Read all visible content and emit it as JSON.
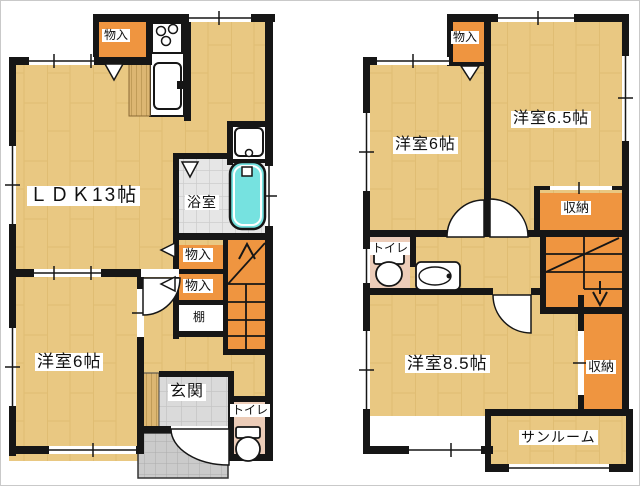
{
  "figure": {
    "type": "floor-plan",
    "floors": [
      "1F",
      "2F"
    ]
  },
  "colors": {
    "floor_wood": "#e9c882",
    "closet_orange": "#ef9540",
    "wall_black": "#161616",
    "bathtub_cyan": "#76e2e0",
    "toilet_floor_pink": "#ecccb8",
    "tile_gray": "#e6e6e6",
    "entry_gray": "#dadada",
    "porch_gray": "#cbcbcb"
  },
  "floor1": {
    "labels": {
      "closet_top": "物入",
      "ldk": "ＬＤＫ13帖",
      "bath": "浴室",
      "closet_a": "物入",
      "closet_b": "物入",
      "shelf": "棚",
      "bedroom6": "洋室6帖",
      "entrance": "玄関",
      "toilet": "トイレ"
    }
  },
  "floor2": {
    "labels": {
      "closet_top": "物入",
      "bedroom6": "洋室6帖",
      "bedroom65": "洋室6.5帖",
      "storage_top": "収納",
      "toilet": "トイレ",
      "bedroom85": "洋室8.5帖",
      "storage_right": "収納",
      "sunroom": "サンルーム"
    }
  }
}
